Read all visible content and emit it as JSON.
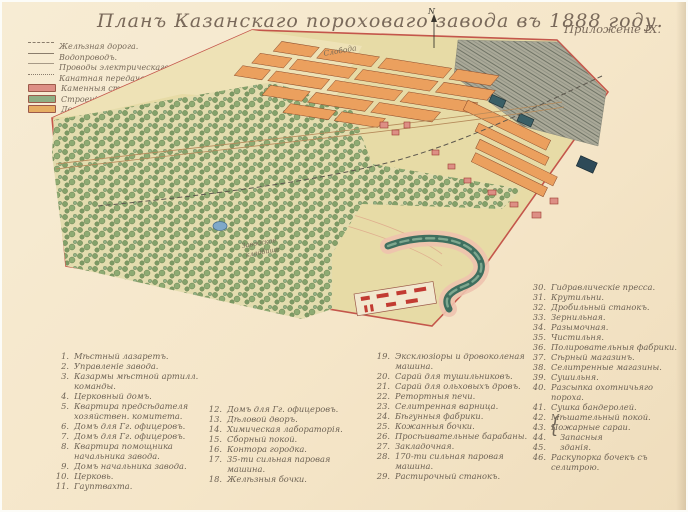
{
  "header": {
    "title": "Планъ Казанскаго пороховаго завода въ 1888 году.",
    "appendix": "Приложеніе IX.",
    "scale": "Масштабъ 150 саж. въ дюймѣ."
  },
  "legend": {
    "lines": [
      {
        "style": "railway",
        "label": "Желѣзная дорога."
      },
      {
        "style": "solid",
        "label": "Водопроводъ."
      },
      {
        "style": "thin",
        "label": "Проводы электрическаго освѣщенія."
      },
      {
        "style": "dotted",
        "label": "Канатная передача."
      }
    ],
    "swatches": [
      {
        "color": "#dd8f85",
        "label": "Каменныя строенія."
      },
      {
        "color": "#8fae83",
        "label": "Строенія изъ волнистаго желѣза."
      },
      {
        "color": "#e6ad62",
        "label": "Деревянныя строенія."
      }
    ]
  },
  "map": {
    "north_label": "N",
    "labels": [
      {
        "text": "Слобода"
      },
      {
        "text": "Заводское"
      },
      {
        "text": "кладбище"
      }
    ],
    "colors": {
      "boundary": "#c4564b",
      "land": "#e7dba6",
      "forest_tree": "#7f9e66",
      "settlement_block": "#eba05e",
      "river": "#3f6f5f",
      "hatch_field": "#a8a896"
    }
  },
  "index": {
    "brace": "{",
    "columns": [
      {
        "items": [
          {
            "num": "1.",
            "label": "Мѣстный лазаретъ."
          },
          {
            "num": "2.",
            "label": "Управленіе завода."
          },
          {
            "num": "3.",
            "label": "Казармы мѣстной артилл. команды."
          },
          {
            "num": "4.",
            "label": "Церковный домъ."
          },
          {
            "num": "5.",
            "label": "Квартира предсѣдателя хозяйствен. комитета."
          },
          {
            "num": "6.",
            "label": "Домъ для Гг. офицеровъ."
          },
          {
            "num": "7.",
            "label": "Домъ для Гг. офицеровъ."
          },
          {
            "num": "8.",
            "label": "Квартира помощника начальника завода."
          },
          {
            "num": "9.",
            "label": "Домъ начальника завода."
          },
          {
            "num": "10.",
            "label": "Церковь."
          },
          {
            "num": "11.",
            "label": "Гауптвахта."
          }
        ]
      },
      {
        "items": [
          {
            "num": "12.",
            "label": "Домъ для Гг. офицеровъ."
          },
          {
            "num": "13.",
            "label": "Дѣловой дворъ."
          },
          {
            "num": "14.",
            "label": "Химическая лабораторія."
          },
          {
            "num": "15.",
            "label": "Сборный покой."
          },
          {
            "num": "16.",
            "label": "Контора городка."
          },
          {
            "num": "17.",
            "label": "35-ти сильная паровая машина."
          },
          {
            "num": "18.",
            "label": "Желѣзныя бочки."
          }
        ]
      },
      {
        "items": [
          {
            "num": "19.",
            "label": "Эксклюзіоры и дровоколеная машина."
          },
          {
            "num": "20.",
            "label": "Сарай для тушильниковъ."
          },
          {
            "num": "21.",
            "label": "Сарай для ольховыхъ дровъ."
          },
          {
            "num": "22.",
            "label": "Ретортныя печи."
          },
          {
            "num": "23.",
            "label": "Селитренная варница."
          },
          {
            "num": "24.",
            "label": "Бѣгунныя фабрики."
          },
          {
            "num": "25.",
            "label": "Кожанныя бочки."
          },
          {
            "num": "26.",
            "label": "Просѣивательные барабаны."
          },
          {
            "num": "27.",
            "label": "Закладочная."
          },
          {
            "num": "28.",
            "label": "170-ти сильная паровая машина."
          },
          {
            "num": "29.",
            "label": "Растирочный станокъ."
          }
        ]
      },
      {
        "items": [
          {
            "num": "30.",
            "label": "Гидравлическіе пресса."
          },
          {
            "num": "31.",
            "label": "Крутильни."
          },
          {
            "num": "32.",
            "label": "Дробильный станокъ."
          },
          {
            "num": "33.",
            "label": "Зернильная."
          },
          {
            "num": "34.",
            "label": "Разымочная."
          },
          {
            "num": "35.",
            "label": "Чистильня."
          },
          {
            "num": "36.",
            "label": "Полировательныя фабрики."
          },
          {
            "num": "37.",
            "label": "Сѣрный магазинъ."
          },
          {
            "num": "38.",
            "label": "Селитренные магазины."
          },
          {
            "num": "39.",
            "label": "Сушильня."
          },
          {
            "num": "40.",
            "label": "Разсыпка охотничьяго пороха."
          },
          {
            "num": "41.",
            "label": "Сушка бандеролей."
          },
          {
            "num": "42.",
            "label": "Мѣшательный покой."
          },
          {
            "num": "43.",
            "label": "Пожарные сараи."
          },
          {
            "num": "44.",
            "label": "Запасныя",
            "cls": "brace-row"
          },
          {
            "num": "45.",
            "label": "зданія.",
            "cls": "brace-row"
          },
          {
            "num": "46.",
            "label": "Раскупорка бочекъ съ селитрою."
          }
        ]
      }
    ]
  }
}
